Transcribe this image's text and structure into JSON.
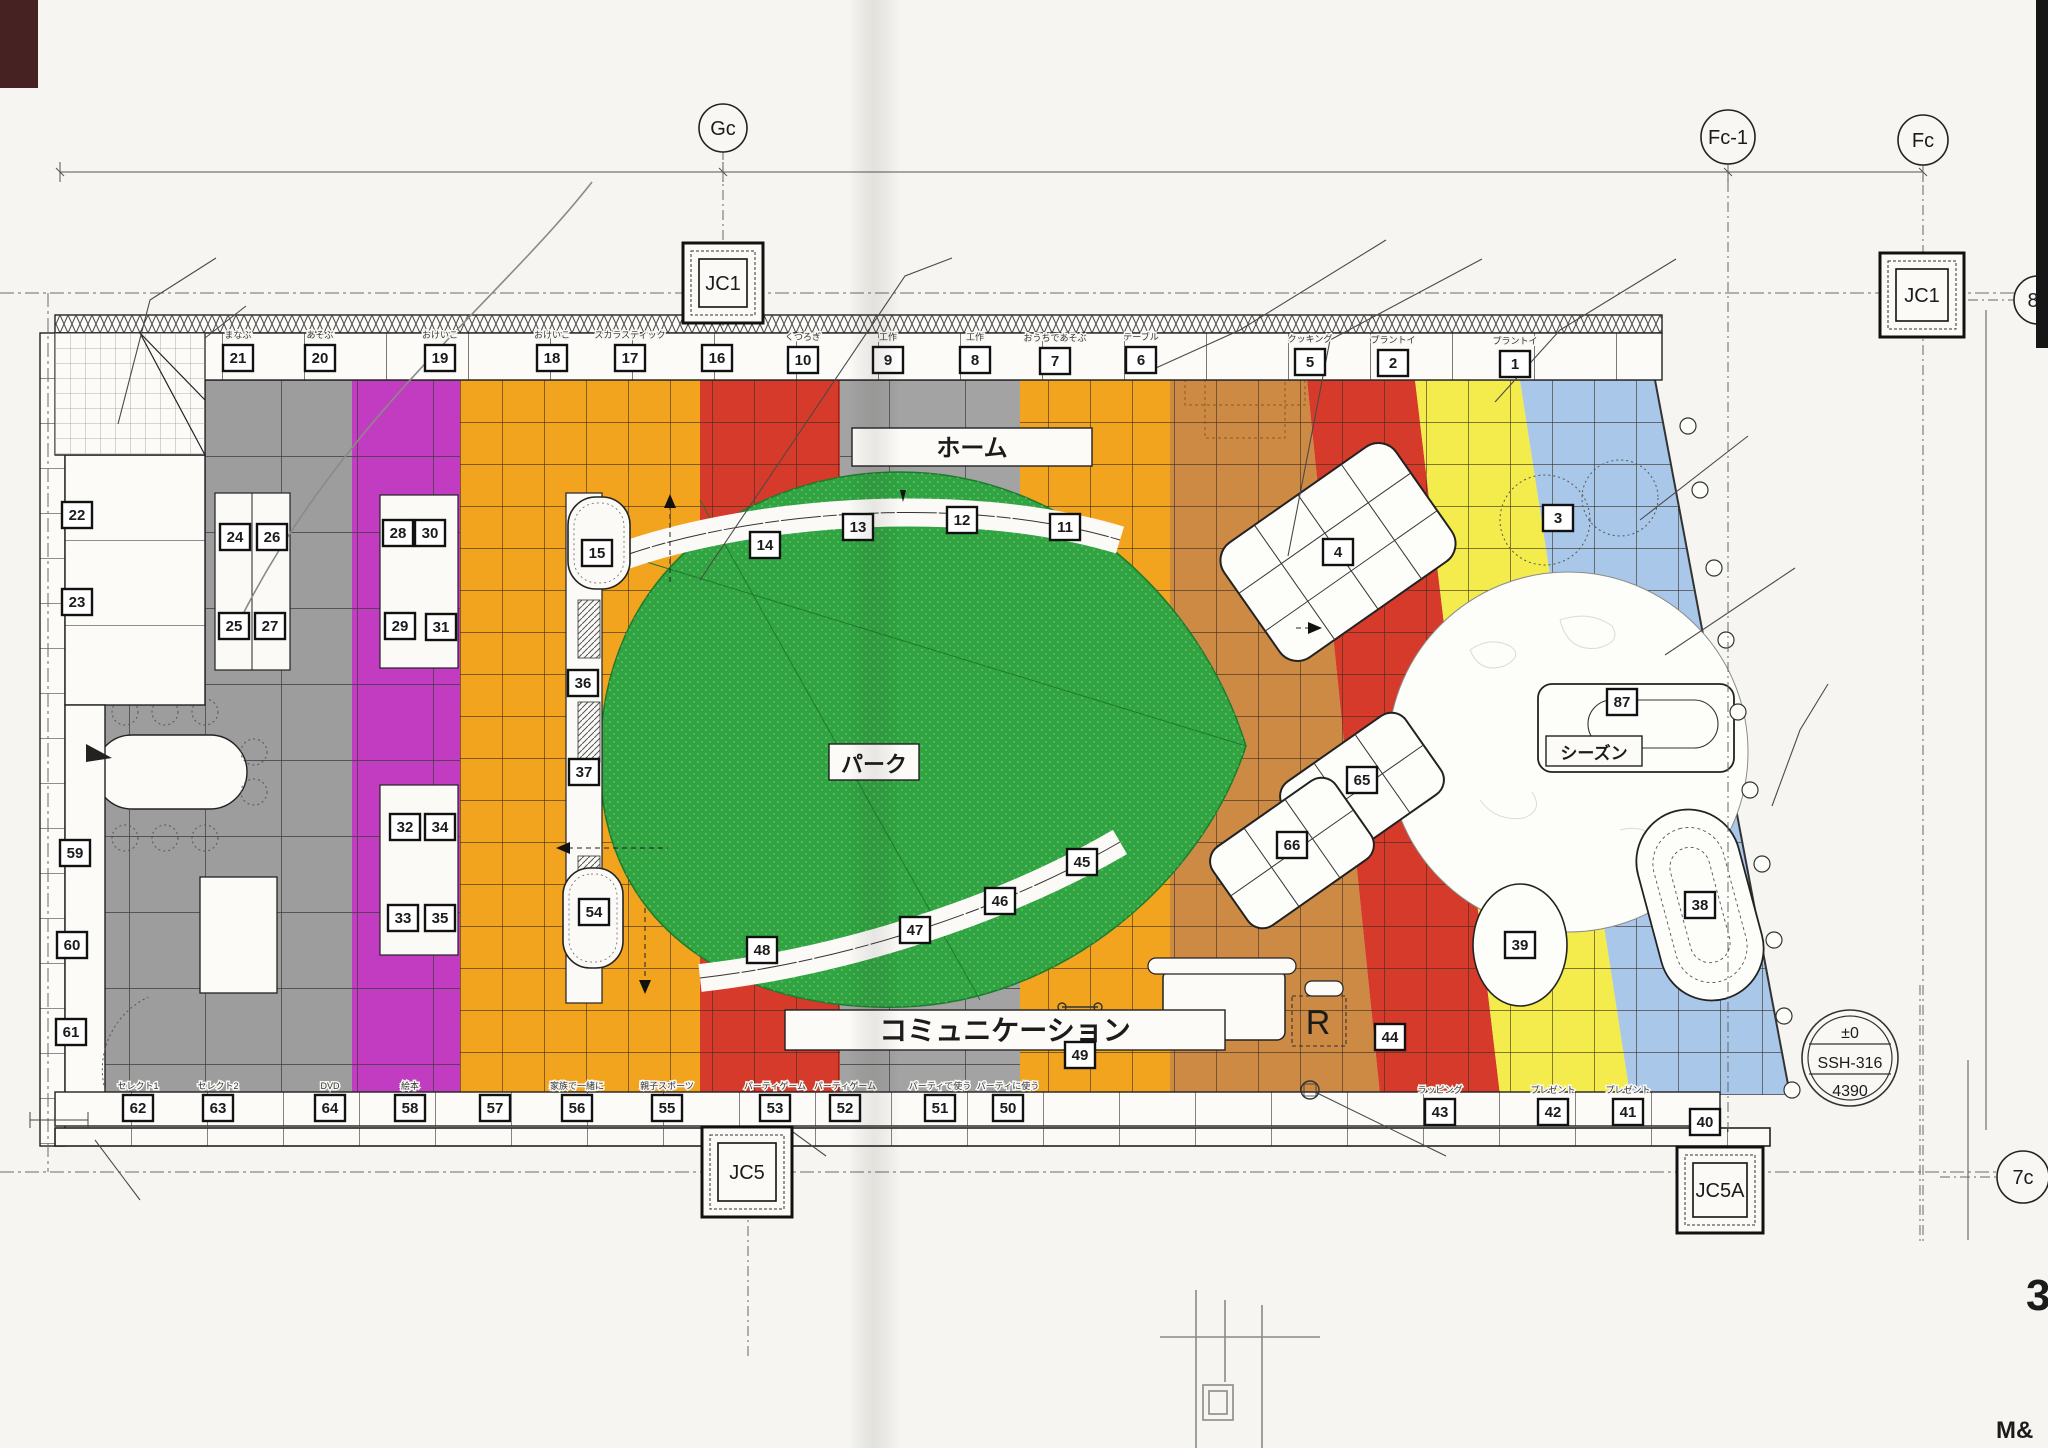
{
  "colors": {
    "gray": "#9d9d9d",
    "magenta": "#c23cc2",
    "orange": "#f2a41f",
    "tan": "#cc8a45",
    "red": "#d63a2a",
    "yellow": "#f3ec4c",
    "blue": "#a9c7e9",
    "green": "#2fa440",
    "line": "#3b3b3b",
    "paper": "#f6f5f1"
  },
  "bubbles": [
    {
      "t": "Gc",
      "x": 723,
      "y": 128,
      "r": 24
    },
    {
      "t": "Fc-1",
      "x": 1728,
      "y": 137,
      "r": 27
    },
    {
      "t": "Fc",
      "x": 1923,
      "y": 140,
      "r": 25
    },
    {
      "t": "8c",
      "x": 2038,
      "y": 300,
      "r": 24
    },
    {
      "t": "7c",
      "x": 2023,
      "y": 1177,
      "r": 26
    }
  ],
  "jc": [
    {
      "t": "JC1",
      "x": 683,
      "y": 243,
      "w": 80
    },
    {
      "t": "JC1",
      "x": 1880,
      "y": 253,
      "w": 84
    },
    {
      "t": "JC5",
      "x": 702,
      "y": 1127,
      "w": 90
    },
    {
      "t": "JC5A",
      "x": 1677,
      "y": 1147,
      "w": 86
    }
  ],
  "dims": [
    {
      "t": "9000",
      "x": 390,
      "y": 158,
      "s": 20
    },
    {
      "t": "10000",
      "x": 1220,
      "y": 163,
      "s": 20
    },
    {
      "t": "2000",
      "x": 1827,
      "y": 168,
      "s": 20
    },
    {
      "t": "9000",
      "x": 1998,
      "y": 560,
      "r": 90,
      "s": 18
    },
    {
      "t": "450",
      "x": 413,
      "y": 352,
      "r": -90
    },
    {
      "t": "1200",
      "x": 387,
      "y": 436,
      "r": -90
    },
    {
      "t": "1200",
      "x": 158,
      "y": 622
    },
    {
      "t": "1000",
      "x": 338,
      "y": 622
    },
    {
      "t": "1200",
      "x": 515,
      "y": 622
    },
    {
      "t": "900",
      "x": 670,
      "y": 533,
      "r": -90
    },
    {
      "t": "300",
      "x": 793,
      "y": 527,
      "r": -70
    },
    {
      "t": "1200",
      "x": 945,
      "y": 438,
      "r": -90
    },
    {
      "t": "900",
      "x": 1468,
      "y": 431,
      "r": -90
    },
    {
      "t": "900",
      "x": 1564,
      "y": 426,
      "r": -90
    },
    {
      "t": "1200",
      "x": 1475,
      "y": 512
    },
    {
      "t": "1200",
      "x": 1560,
      "y": 625,
      "r": -90
    },
    {
      "t": "1100",
      "x": 1179,
      "y": 627,
      "r": -90
    },
    {
      "t": "1100",
      "x": 1179,
      "y": 755,
      "r": -90
    },
    {
      "t": "6750",
      "x": 910,
      "y": 705,
      "r": 12
    },
    {
      "t": "4000",
      "x": 813,
      "y": 730,
      "r": 55
    },
    {
      "t": "950",
      "x": 1123,
      "y": 915,
      "r": 55
    },
    {
      "t": "600",
      "x": 1138,
      "y": 1008
    },
    {
      "t": "600",
      "x": 632,
      "y": 852,
      "r": -90
    },
    {
      "t": "900",
      "x": 662,
      "y": 966
    },
    {
      "t": "280",
      "x": 733,
      "y": 1070
    },
    {
      "t": "1200",
      "x": 768,
      "y": 1031,
      "r": -90
    },
    {
      "t": "1200",
      "x": 400,
      "y": 1020,
      "r": -90
    },
    {
      "t": "300",
      "x": 858,
      "y": 940,
      "r": -75
    },
    {
      "t": "100",
      "x": 42,
      "y": 1116
    },
    {
      "t": "100",
      "x": 25,
      "y": 745,
      "r": -90
    },
    {
      "t": "400",
      "x": 1940,
      "y": 1160,
      "r": -90
    }
  ],
  "ann": [
    {
      "t": "バスタブ:別途",
      "x": 218,
      "y": 263
    },
    {
      "t": "長尺シート貼",
      "x": 248,
      "y": 311
    },
    {
      "t": "タイルカーペット:グランドアート/東リ",
      "x": 957,
      "y": 263
    },
    {
      "t": "別途",
      "x": 1390,
      "y": 244
    },
    {
      "t": "真鍮目地棒",
      "x": 1486,
      "y": 264
    },
    {
      "t": "タイル:リノテスタ/東リ",
      "x": 1678,
      "y": 264
    },
    {
      "t": "2枚貼",
      "x": 1678,
      "y": 284
    },
    {
      "t": "モニター",
      "x": 1512,
      "y": 402
    },
    {
      "t": "別途",
      "x": 1752,
      "y": 441
    },
    {
      "t": "デジタル出力タイル",
      "x": 1798,
      "y": 573
    },
    {
      "t": "2枚貼",
      "x": 1798,
      "y": 593
    },
    {
      "t": "リースライン",
      "x": 1832,
      "y": 689
    },
    {
      "t": "樹脂目地棒(A工事支給)",
      "x": 1832,
      "y": 709
    },
    {
      "t": "排煙SW",
      "x": 116,
      "y": 760
    },
    {
      "t": "モニター",
      "x": 243,
      "y": 1070
    },
    {
      "t": "(モニター)",
      "x": 870,
      "y": 1074
    },
    {
      "t": "〈モニター〉",
      "x": 1460,
      "y": 1074
    },
    {
      "t": "〈モニター〉",
      "x": 408,
      "y": 394,
      "s": 13
    },
    {
      "t": "〈テーマ〉",
      "x": 1598,
      "y": 526,
      "s": 18
    },
    {
      "t": "プラントイ",
      "x": 1575,
      "y": 503,
      "s": 9
    },
    {
      "t": "電話",
      "x": 1450,
      "y": 1166
    },
    {
      "t": "分電盤",
      "x": 142,
      "y": 1206
    },
    {
      "t": "下場FLより2500以上",
      "x": 142,
      "y": 1225
    },
    {
      "t": "サーモスタット",
      "x": 830,
      "y": 1161
    },
    {
      "t": "A壁orA柱取付",
      "x": 830,
      "y": 1180
    },
    {
      "t": "FLより1500",
      "x": 830,
      "y": 1198
    },
    {
      "t": "W=5,230",
      "x": 1905,
      "y": 1064,
      "s": 18
    },
    {
      "t": "(管理用電動シャッター) SSH芯",
      "x": 1800,
      "y": 1130
    },
    {
      "t": "凹凸ミラー貼",
      "x": 872,
      "y": 486,
      "s": 12
    },
    {
      "t": "スラットウォール+ポリ板ボード",
      "x": 800,
      "y": 582,
      "s": 11
    },
    {
      "t": "はめ込み式",
      "x": 868,
      "y": 596,
      "s": 11
    },
    {
      "t": "スラットウォール+ポリ板ボード",
      "x": 790,
      "y": 840,
      "s": 11
    },
    {
      "t": "はめ込み式",
      "x": 858,
      "y": 854,
      "s": 11
    },
    {
      "t": "プレゼント",
      "x": 1522,
      "y": 922,
      "s": 9
    },
    {
      "t": "1200×900",
      "x": 1515,
      "y": 978,
      "s": 11
    },
    {
      "t": "1800×900",
      "x": 1690,
      "y": 970,
      "s": 11
    },
    {
      "t": "TABLE",
      "x": 148,
      "y": 778,
      "s": 15
    },
    {
      "t": "1500×800",
      "x": 145,
      "y": 797,
      "s": 11
    },
    {
      "t": "TABLE",
      "x": 214,
      "y": 938,
      "s": 15
    },
    {
      "t": "1200×800",
      "x": 211,
      "y": 957,
      "s": 11
    },
    {
      "t": "BRAZIL",
      "x": 1402,
      "y": 750,
      "s": 8,
      "f": 1
    }
  ],
  "top_row": [
    {
      "n": "21",
      "label": "まなぶ",
      "x": 238,
      "y": 358
    },
    {
      "n": "20",
      "label": "あそぶ",
      "x": 320,
      "y": 358
    },
    {
      "n": "19",
      "label": "おけいこ",
      "x": 440,
      "y": 358
    },
    {
      "n": "18",
      "label": "おけいこ",
      "x": 552,
      "y": 358
    },
    {
      "n": "17",
      "label": "スカラスティック",
      "x": 630,
      "y": 358
    },
    {
      "n": "16",
      "label": "",
      "x": 717,
      "y": 358
    },
    {
      "n": "10",
      "label": "くつろぎ",
      "x": 803,
      "y": 360
    },
    {
      "n": "9",
      "label": "工作",
      "x": 888,
      "y": 360
    },
    {
      "n": "8",
      "label": "工作",
      "x": 975,
      "y": 360
    },
    {
      "n": "7",
      "label": "おうちであそぶ",
      "x": 1055,
      "y": 361
    },
    {
      "n": "6",
      "label": "テーブル",
      "x": 1141,
      "y": 360
    },
    {
      "n": "5",
      "label": "クッキング",
      "x": 1310,
      "y": 362
    },
    {
      "n": "2",
      "label": "プラントイ",
      "x": 1393,
      "y": 363
    },
    {
      "n": "1",
      "label": "プラントイ",
      "x": 1515,
      "y": 364
    }
  ],
  "bottom_row": [
    {
      "n": "62",
      "label": "セレクト1",
      "x": 138,
      "y": 1108
    },
    {
      "n": "63",
      "label": "セレクト2",
      "x": 218,
      "y": 1108
    },
    {
      "n": "64",
      "label": "DVD",
      "x": 330,
      "y": 1108
    },
    {
      "n": "58",
      "label": "絵本",
      "x": 410,
      "y": 1108
    },
    {
      "n": "57",
      "label": "",
      "x": 495,
      "y": 1108
    },
    {
      "n": "56",
      "label": "家族で一緒に",
      "x": 577,
      "y": 1108
    },
    {
      "n": "55",
      "label": "親子スポーツ",
      "x": 667,
      "y": 1108
    },
    {
      "n": "53",
      "label": "パーティゲーム",
      "x": 775,
      "y": 1108
    },
    {
      "n": "52",
      "label": "パーティゲーム",
      "x": 845,
      "y": 1108
    },
    {
      "n": "51",
      "label": "パーティで使う",
      "x": 940,
      "y": 1108
    },
    {
      "n": "50",
      "label": "パーティに使う",
      "x": 1008,
      "y": 1108
    },
    {
      "n": "43",
      "label": "ラッピング",
      "x": 1440,
      "y": 1112
    },
    {
      "n": "42",
      "label": "プレゼント",
      "x": 1553,
      "y": 1112
    },
    {
      "n": "41",
      "label": "プレゼント",
      "x": 1628,
      "y": 1112
    }
  ],
  "boxes": [
    {
      "n": "22",
      "x": 77,
      "y": 515
    },
    {
      "n": "23",
      "x": 77,
      "y": 602
    },
    {
      "n": "59",
      "x": 75,
      "y": 853
    },
    {
      "n": "60",
      "x": 72,
      "y": 945
    },
    {
      "n": "61",
      "x": 71,
      "y": 1032
    },
    {
      "n": "24",
      "x": 235,
      "y": 537
    },
    {
      "n": "26",
      "x": 272,
      "y": 537
    },
    {
      "n": "25",
      "x": 234,
      "y": 626
    },
    {
      "n": "27",
      "x": 270,
      "y": 626
    },
    {
      "n": "28",
      "x": 398,
      "y": 533
    },
    {
      "n": "30",
      "x": 430,
      "y": 533
    },
    {
      "n": "29",
      "x": 400,
      "y": 626
    },
    {
      "n": "31",
      "x": 441,
      "y": 627
    },
    {
      "n": "32",
      "x": 405,
      "y": 827
    },
    {
      "n": "34",
      "x": 440,
      "y": 827
    },
    {
      "n": "33",
      "x": 403,
      "y": 918
    },
    {
      "n": "35",
      "x": 440,
      "y": 918
    },
    {
      "n": "36",
      "x": 583,
      "y": 683
    },
    {
      "n": "37",
      "x": 584,
      "y": 772
    },
    {
      "n": "15",
      "x": 597,
      "y": 553
    },
    {
      "n": "54",
      "x": 594,
      "y": 912
    },
    {
      "n": "14",
      "x": 765,
      "y": 545
    },
    {
      "n": "13",
      "x": 858,
      "y": 527
    },
    {
      "n": "12",
      "x": 962,
      "y": 520
    },
    {
      "n": "11",
      "x": 1065,
      "y": 527
    },
    {
      "n": "48",
      "x": 762,
      "y": 950
    },
    {
      "n": "47",
      "x": 915,
      "y": 930
    },
    {
      "n": "46",
      "x": 1000,
      "y": 901
    },
    {
      "n": "45",
      "x": 1082,
      "y": 862
    },
    {
      "n": "3",
      "x": 1558,
      "y": 518
    },
    {
      "n": "87",
      "x": 1622,
      "y": 702
    },
    {
      "n": "4",
      "x": 1338,
      "y": 552
    },
    {
      "n": "65",
      "x": 1362,
      "y": 780
    },
    {
      "n": "66",
      "x": 1292,
      "y": 845
    },
    {
      "n": "39",
      "x": 1520,
      "y": 945
    },
    {
      "n": "38",
      "x": 1700,
      "y": 905
    },
    {
      "n": "44",
      "x": 1390,
      "y": 1037
    },
    {
      "n": "49",
      "x": 1080,
      "y": 1055
    },
    {
      "n": "40",
      "x": 1705,
      "y": 1122
    }
  ],
  "vlabels": [
    {
      "t": "モニター",
      "x": 620,
      "y": 700
    },
    {
      "t": "使う",
      "x": 102,
      "y": 498
    },
    {
      "t": "おやすみ",
      "x": 102,
      "y": 585
    },
    {
      "t": "テーマ",
      "x": 102,
      "y": 838
    },
    {
      "t": "仕掛け",
      "x": 98,
      "y": 1008
    },
    {
      "t": "ボール遊び",
      "x": 287,
      "y": 440
    },
    {
      "t": "体を鍛える",
      "x": 280,
      "y": 560
    },
    {
      "t": "H1350",
      "x": 452,
      "y": 555
    },
    {
      "t": "ピクニック",
      "x": 455,
      "y": 845
    },
    {
      "t": "おでかけ",
      "x": 418,
      "y": 862
    }
  ],
  "zone_labels": [
    {
      "t": "ホーム",
      "x": 972,
      "y": 456,
      "bw": 240,
      "bx": 852,
      "by": 428,
      "bh": 38,
      "s": 24
    },
    {
      "t": "パーク",
      "x": 874,
      "y": 772,
      "bw": 90,
      "bx": 829,
      "by": 744,
      "bh": 36,
      "s": 22
    },
    {
      "t": "コミュニケーション",
      "x": 1005,
      "y": 1040,
      "bw": 440,
      "bx": 785,
      "by": 1010,
      "bh": 40,
      "s": 28
    },
    {
      "t": "シーズン",
      "x": 1594,
      "y": 759,
      "bw": 96,
      "bx": 1546,
      "by": 736,
      "bh": 30,
      "s": 17
    }
  ],
  "ssh": {
    "l1": "±0",
    "l2": "SSH-316",
    "l3": "4390"
  },
  "counter": {
    "r": "R"
  },
  "hand": [
    {
      "t": "女0",
      "x": 318,
      "y": 205,
      "s": 34,
      "r": -8
    },
    {
      "t": "100",
      "x": 1300,
      "y": 1290,
      "s": 42,
      "r": -4
    },
    {
      "t": "1 00",
      "x": 1170,
      "y": 1272,
      "s": 26,
      "r": -2
    }
  ],
  "page": {
    "num": "3",
    "mark": "M&"
  }
}
